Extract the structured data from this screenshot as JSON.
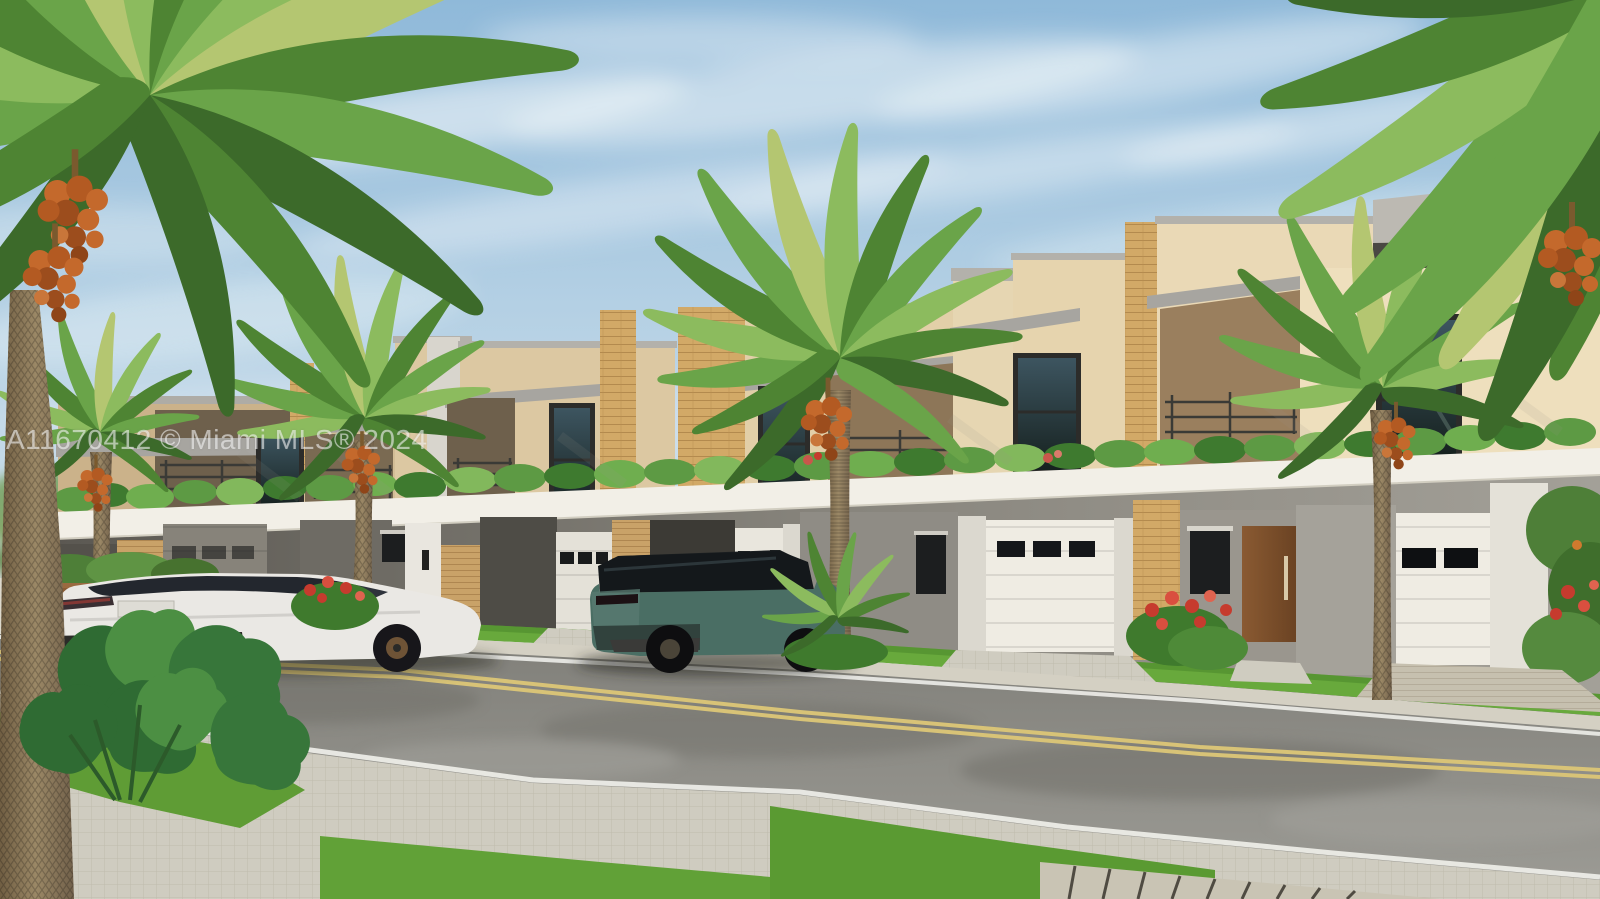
{
  "image": {
    "type": "real-estate-listing-photo",
    "subject": "3D architectural rendering of a row of modern two-story townhomes with balconies, garages, palm trees, a white sedan and a teal SUV along a street",
    "width_px": 1600,
    "height_px": 899
  },
  "watermark": {
    "text": "A11670412 © Miami MLS® 2024",
    "color": "#ffffff",
    "opacity": 0.55
  },
  "scene": {
    "sky": {
      "clouds": "wispy white streaks",
      "condition": "sunny"
    },
    "buildings": {
      "style": "modern flat-roof townhomes",
      "stories": 2,
      "units_visible": 7,
      "features": [
        "tan stucco parapets",
        "gray roof fascia",
        "tan brick pilasters",
        "dark framed windows",
        "covered balconies with dark metal railings",
        "white planter band with green plants",
        "white garage doors with dark window strips",
        "wood entry door",
        "red flowering shrubs"
      ]
    },
    "vehicles": [
      {
        "name": "white-sedan",
        "position": "parked on street at left",
        "view": "rear three-quarter"
      },
      {
        "name": "teal-suv",
        "position": "parked in center driveway",
        "view": "rear three-quarter"
      }
    ],
    "vegetation": [
      "large date palm foreground top-left",
      "row of date palms with orange date clusters",
      "monstera plants bottom-left",
      "hedge with red flowers far right",
      "lawns and balcony planters"
    ],
    "street": {
      "markings": [
        "double yellow center line",
        "white edge lines"
      ],
      "surfaces": [
        "gray asphalt",
        "paver sidewalk",
        "paver driveways",
        "grass parkway strips"
      ]
    },
    "palette": {
      "sky_top": "#8fb9d9",
      "sky_horizon": "#dce8ef",
      "cloud_white": "#f4f8fa",
      "stucco_sunlit": "#eedfbd",
      "stucco_mid": "#d9c49c",
      "stucco_shadow": "#c3a87f",
      "brick_tan": "#d2a967",
      "fascia_gray": "#a7a5a0",
      "soffit_dark": "#4a4843",
      "band_white": "#f2efe7",
      "recess_shadow": "#6e604c",
      "window_glass": "#222d31",
      "railing_dark": "#3a3a36",
      "plant_green": "#5d9a44",
      "lawn_green": "#68a93c",
      "palm_green": "#6aa449",
      "palm_light": "#b4c671",
      "date_orange": "#c4692c",
      "trunk_brown": "#97835f",
      "ground_wall_gray": "#8f8c85",
      "garage_white": "#efece3",
      "sidewalk": "#d4d0c3",
      "paver_light": "#cfccc0",
      "asphalt": "#8e8d88",
      "line_white": "#ecece7",
      "line_yellow": "#d8c377",
      "car_white": "#eae8e4",
      "suv_teal": "#4a6e64",
      "glass_dark": "#1d2126",
      "wheel_dark": "#1c1b19",
      "fence_wood": "#8a5c36",
      "flower_red": "#c63b2e"
    }
  }
}
